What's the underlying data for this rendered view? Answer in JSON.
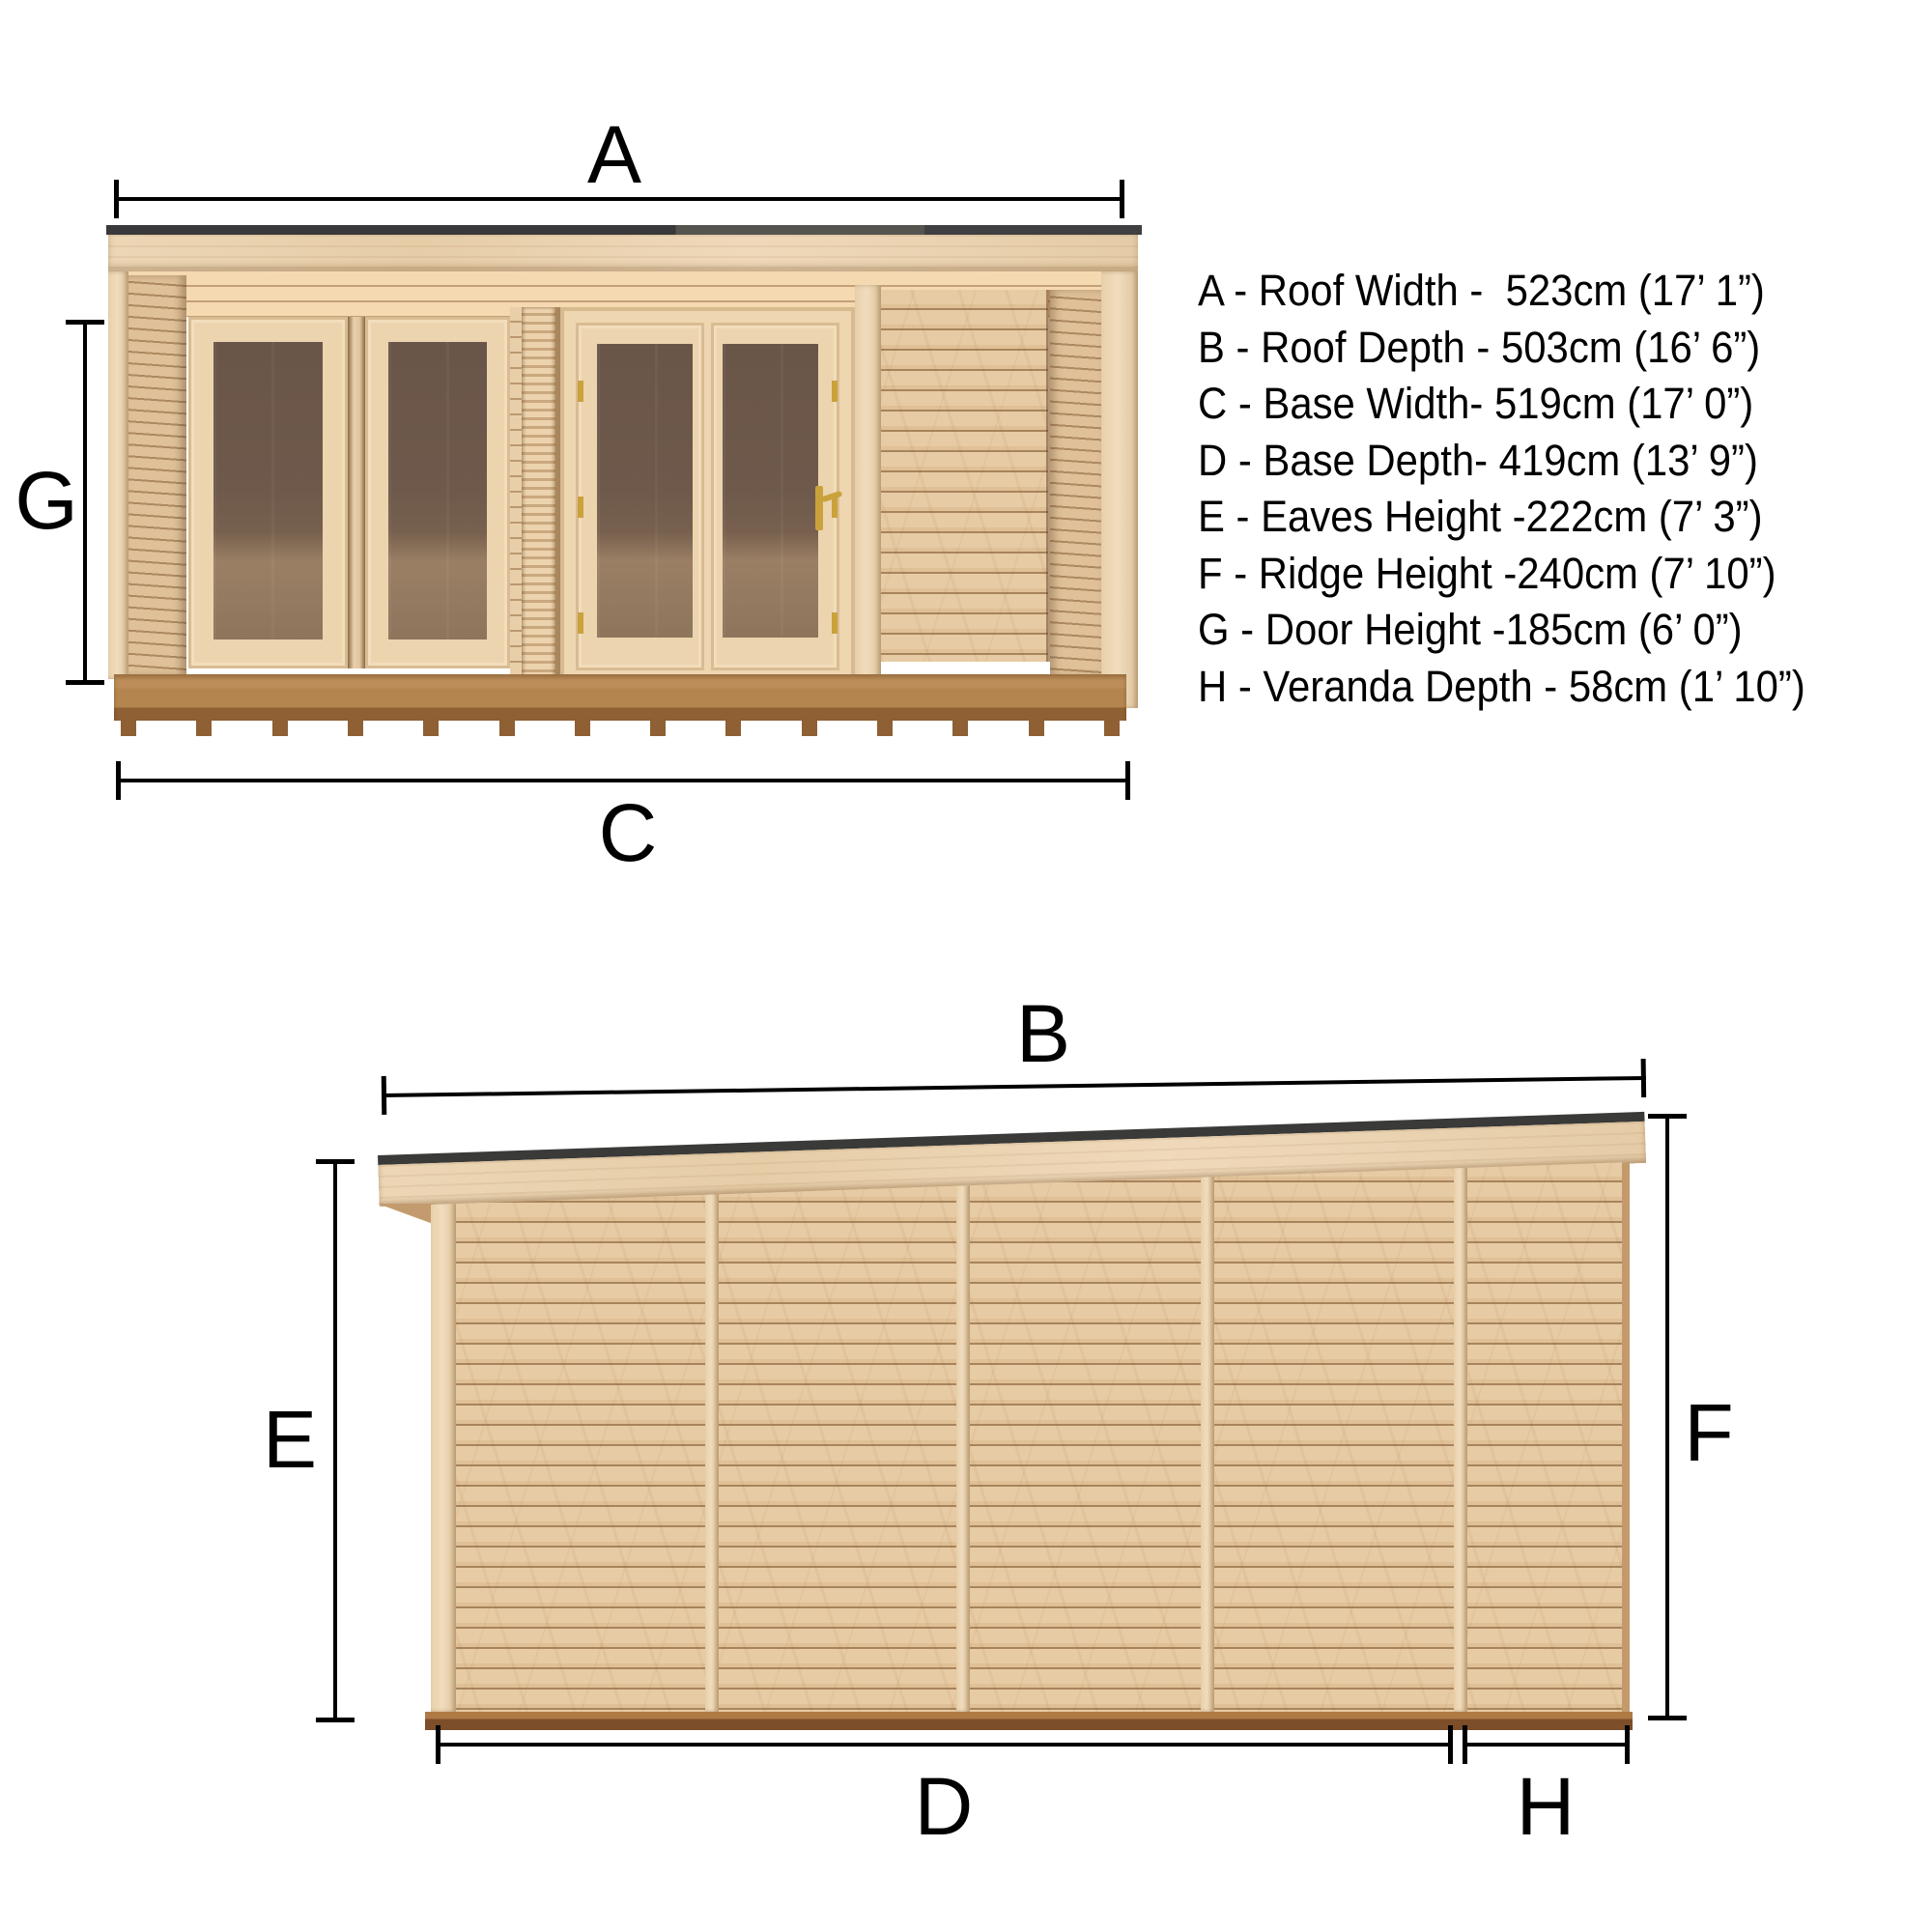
{
  "legend_lines": [
    "A - Roof Width -  523cm (17’ 1”)",
    "B - Roof Depth - 503cm (16’ 6”)",
    "C - Base Width- 519cm (17’ 0”)",
    "D - Base Depth- 419cm (13’ 9”)",
    "E - Eaves Height -222cm (7’ 3”)",
    "F - Ridge Height -240cm (7’ 10”)",
    "G - Door Height -185cm (6’ 0”)",
    "H - Veranda Depth - 58cm (1’ 10”)"
  ],
  "markers": {
    "A": "A",
    "B": "B",
    "C": "C",
    "D": "D",
    "E": "E",
    "F": "F",
    "G": "G",
    "H": "H"
  },
  "dimensions": {
    "A": {
      "name": "Roof Width",
      "metric": "523cm",
      "imperial": "17’ 1”"
    },
    "B": {
      "name": "Roof Depth",
      "metric": "503cm",
      "imperial": "16’ 6”"
    },
    "C": {
      "name": "Base Width",
      "metric": "519cm",
      "imperial": "17’ 0”"
    },
    "D": {
      "name": "Base Depth",
      "metric": "419cm",
      "imperial": "13’ 9”"
    },
    "E": {
      "name": "Eaves Height",
      "metric": "222cm",
      "imperial": "7’ 3”"
    },
    "F": {
      "name": "Ridge Height",
      "metric": "240cm",
      "imperial": "7’ 10”"
    },
    "G": {
      "name": "Door Height",
      "metric": "185cm",
      "imperial": "6’ 0”"
    },
    "H": {
      "name": "Veranda Depth",
      "metric": "58cm",
      "imperial": "1’ 10”"
    }
  },
  "colors": {
    "dimension_lines": "#000000",
    "roof_edge": "#3a3a38",
    "wood_light": "#ecd6b5",
    "wood_mid": "#e2c39c",
    "wood_groove": "#c5a172",
    "glass_dark": "#6a5549",
    "glass_floor": "#9a7f64",
    "deck": "#b5854f",
    "deck_front": "#8f6034",
    "base_skid": "#7c4e2a",
    "background": "#ffffff"
  }
}
